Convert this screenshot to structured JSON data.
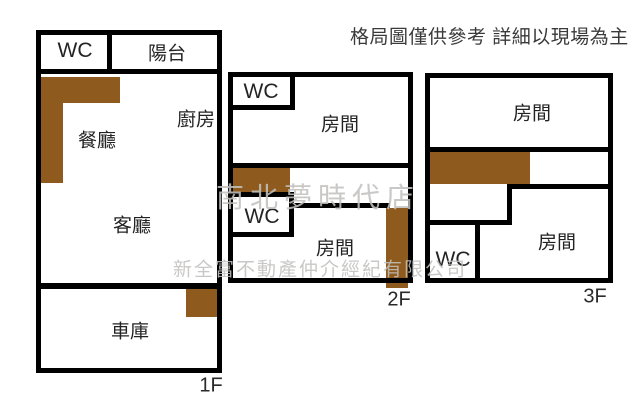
{
  "disclaimer": "格局圖僅供參考 詳細以現場為主",
  "watermarks": {
    "store": "南北夢時代店",
    "company": "新全富不動產仲介經紀有限公司"
  },
  "colors": {
    "wall": "#000000",
    "stairs": "#8e5a1e",
    "watermark": "#c2c1bf",
    "text": "#3a3a3a"
  },
  "floors": {
    "f1": {
      "label": "1F",
      "rooms": {
        "wc": "WC",
        "balcony": "陽台",
        "kitchen": "廚房",
        "dining": "餐廳",
        "living": "客廳",
        "garage": "車庫"
      }
    },
    "f2": {
      "label": "2F",
      "rooms": {
        "wc_top": "WC",
        "room_top": "房間",
        "wc_mid": "WC",
        "room_bottom": "房間"
      }
    },
    "f3": {
      "label": "3F",
      "rooms": {
        "room_top": "房間",
        "wc": "WC",
        "room_bottom": "房間"
      }
    }
  }
}
